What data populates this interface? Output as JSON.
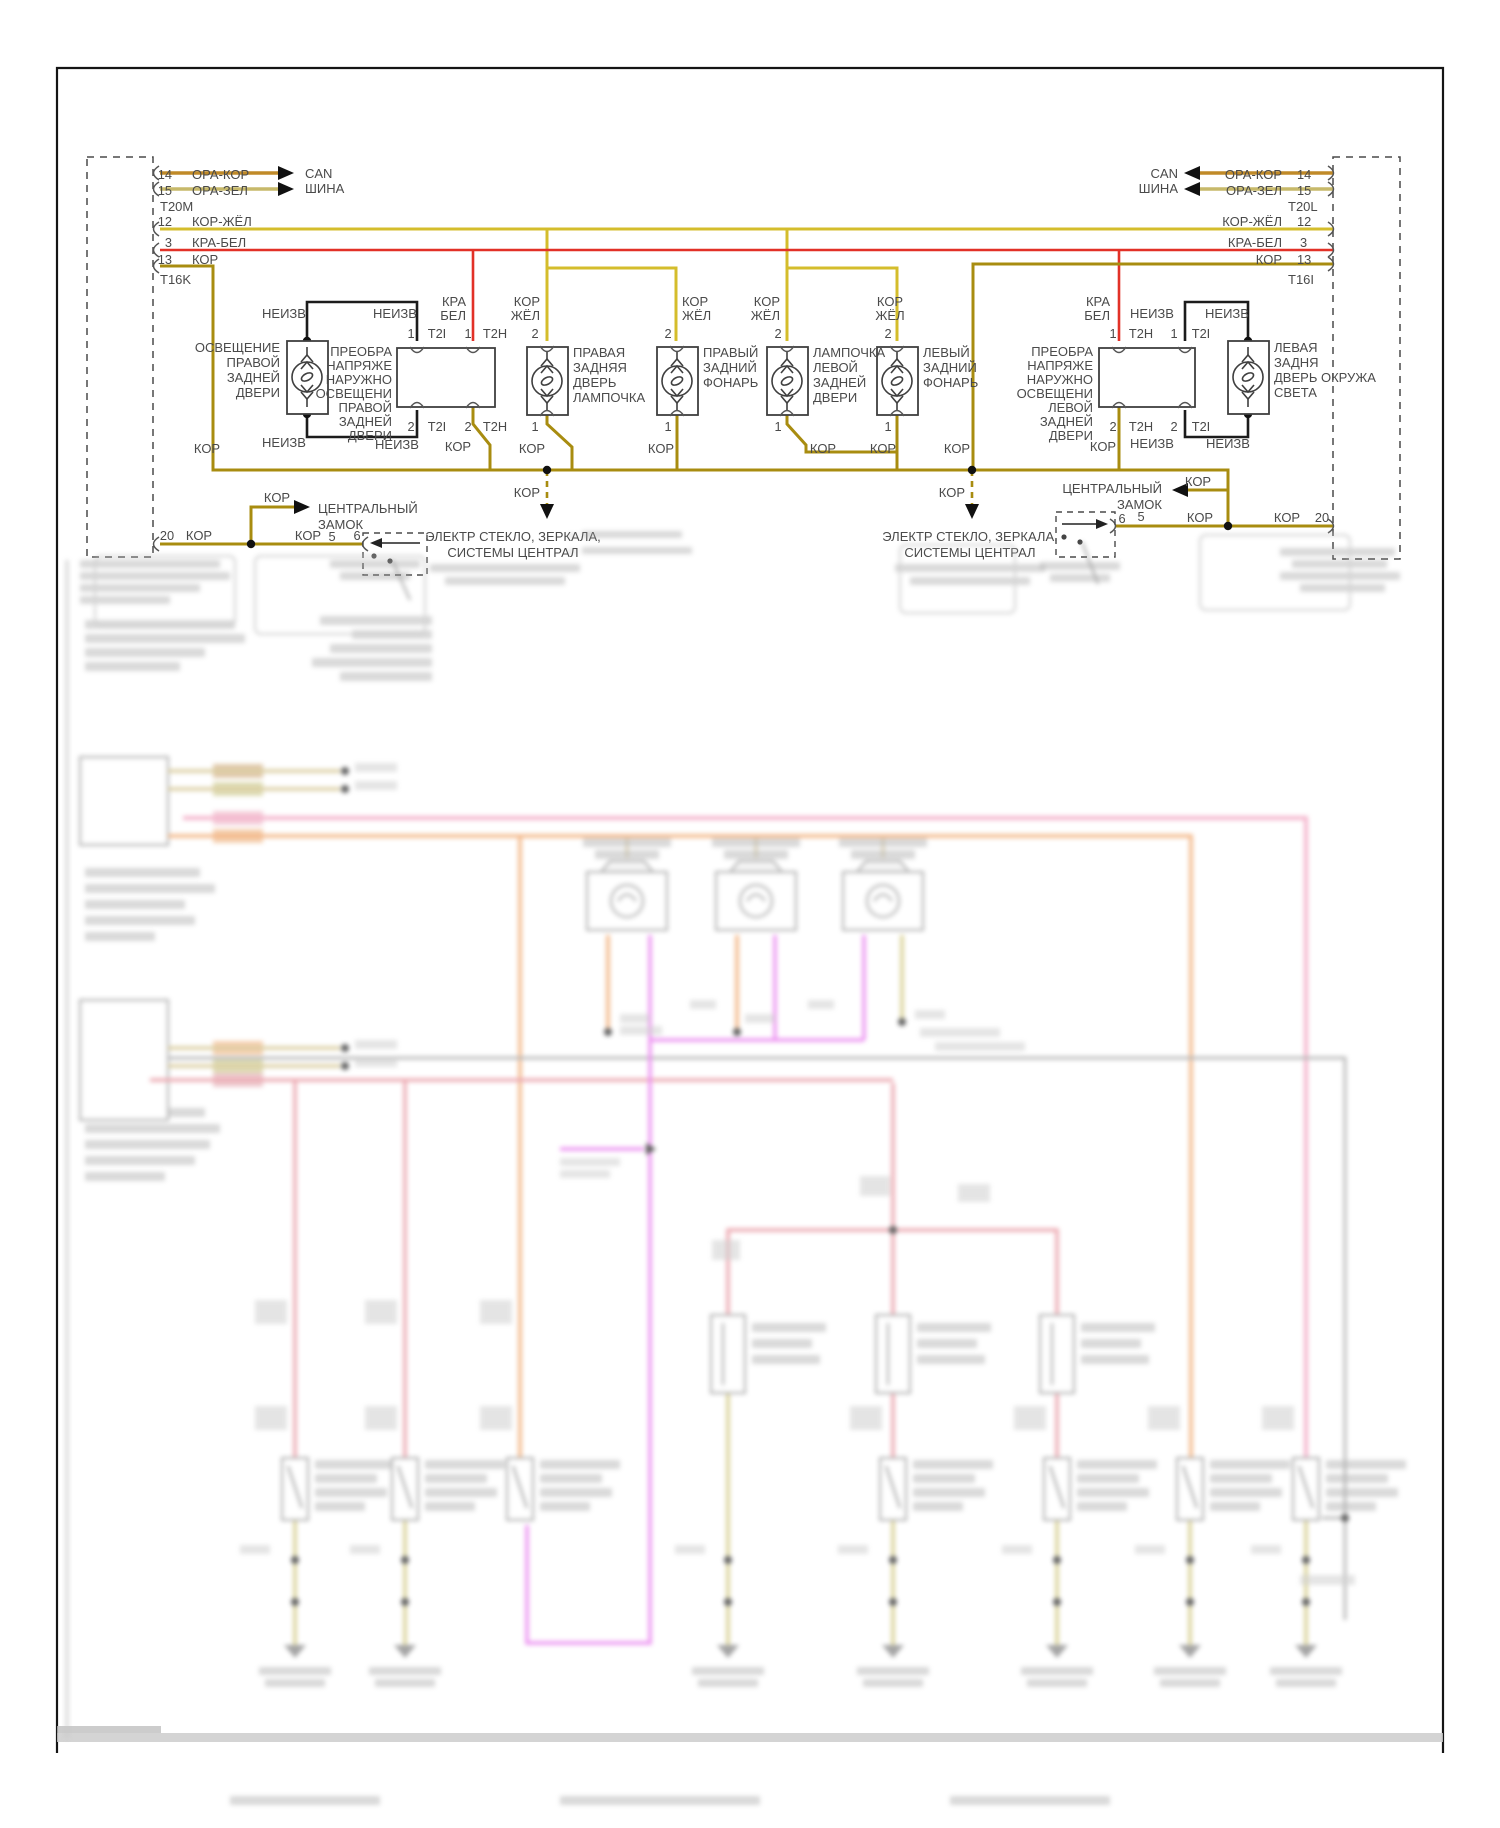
{
  "doc": {
    "type": "vehicle wiring diagram",
    "language": "ru"
  },
  "colors": {
    "kor": "#a88c10",
    "kor_zhel": "#d4bd2c",
    "kra_bel": "#e23127",
    "ora_kor": "#c08a28",
    "ora_zel": "#c7b96a",
    "black_wire": "#1c1c1c",
    "box_stroke": "#3f3f3f",
    "text": "#4a4a4a",
    "blur_pink": "#f2a3c0",
    "blur_red": "#e89aa4",
    "blur_orange": "#f0a468",
    "blur_magenta": "#e878ee",
    "blur_violet": "#cf82e8",
    "blur_olive": "#cfc57a",
    "blur_gray": "#a8a8a8"
  },
  "t": {
    "n1": "1",
    "n2": "2",
    "n3": "3",
    "n5": "5",
    "n6": "6",
    "n12": "12",
    "n13": "13",
    "n14": "14",
    "n15": "15",
    "n20": "20",
    "t20m": "T20M",
    "t16k": "T16K",
    "t20l": "T20L",
    "t16i": "T16I",
    "t2i": "T2I",
    "t2h": "T2H",
    "orakor": "ОРА-КОР",
    "orazel": "ОРА-ЗЕЛ",
    "korzhel": "КОР-ЖЁЛ",
    "krabel": "КРА-БЕЛ",
    "kor": "КОР",
    "kra": "КРА",
    "bel": "БЕЛ",
    "zhel": "ЖЁЛ",
    "neizv": "НЕИЗВ",
    "can": "CAN",
    "shina": "ШИНА"
  },
  "cz": {
    "l1": "ЦЕНТРАЛЬНЫЙ",
    "l2": "ЗАМОК"
  },
  "el": {
    "l1": "ЭЛЕКТР СТЕКЛО, ЗЕРКАЛА,",
    "l2": "СИСТЕМЫ ЦЕНТРАЛ"
  },
  "conv_right_door": {
    "lines": [
      "ПРЕОБРА",
      "НАПРЯЖЕ",
      "НАРУЖНО",
      "ОСВЕЩЕНИ",
      "ПРАВОЙ",
      "ЗАДНЕЙ",
      "ДВЕРИ"
    ]
  },
  "conv_left_door": {
    "lines": [
      "ПРЕОБРА",
      "НАПРЯЖЕ",
      "НАРУЖНО",
      "ОСВЕЩЕНИ",
      "ЛЕВОЙ",
      "ЗАДНЕЙ",
      "ДВЕРИ"
    ]
  },
  "lamp_right_door": {
    "lines": [
      "ОСВЕЩЕНИЕ",
      "ПРАВОЙ",
      "ЗАДНЕЙ",
      "ДВЕРИ"
    ]
  },
  "lamp_right_bulb": {
    "lines": [
      "ПРАВАЯ",
      "ЗАДНЯЯ",
      "ДВЕРЬ",
      "ЛАМПОЧКА"
    ]
  },
  "lamp_right_tail": {
    "lines": [
      "ПРАВЫЙ",
      "ЗАДНИЙ",
      "ФОНАРЬ"
    ]
  },
  "lamp_left_bulb": {
    "lines": [
      "ЛАМПОЧКА",
      "ЛЕВОЙ",
      "ЗАДНЕЙ",
      "ДВЕРИ"
    ]
  },
  "lamp_left_tail": {
    "lines": [
      "ЛЕВЫЙ",
      "ЗАДНИЙ",
      "ФОНАРЬ"
    ]
  },
  "lamp_left_ambient": {
    "lines": [
      "ЛЕВАЯ",
      "ЗАДНЯ",
      "ДВЕРЬ ОКРУЖА",
      "СВЕТА"
    ]
  }
}
